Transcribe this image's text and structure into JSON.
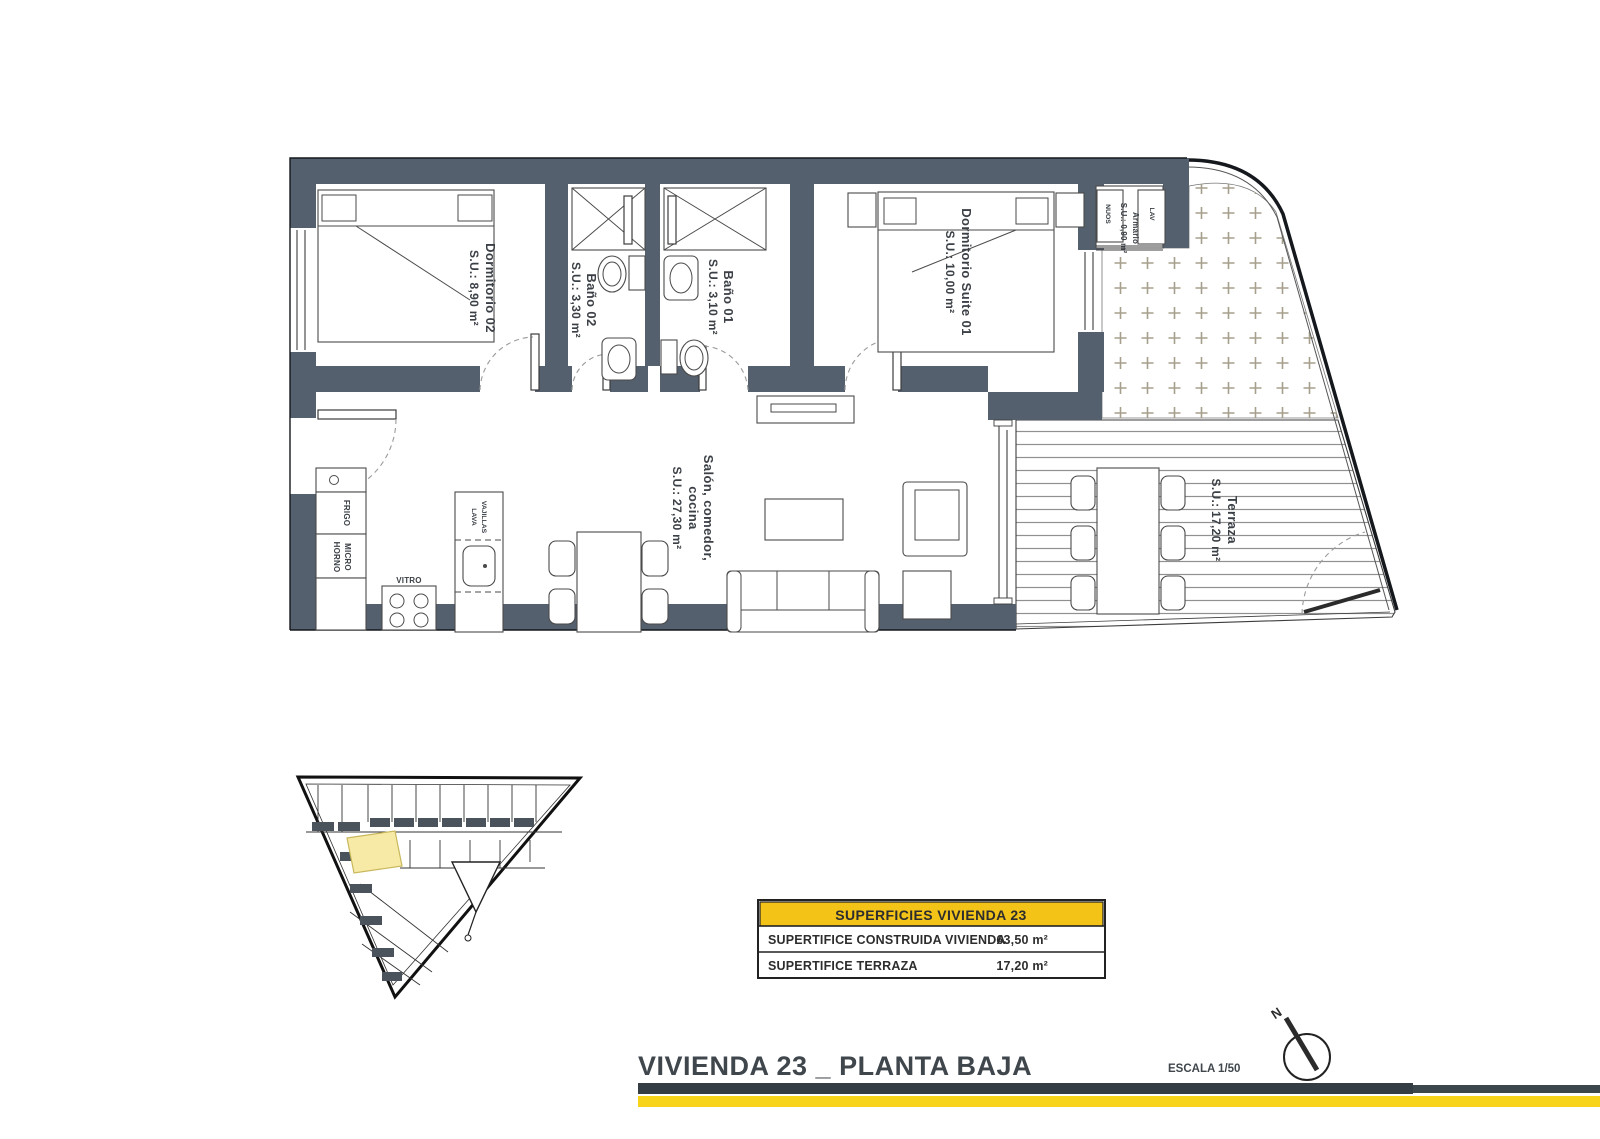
{
  "plan": {
    "rooms": {
      "dorm02": {
        "name": "Dormitorio 02",
        "area": "S.U.: 8,90 m²"
      },
      "bano02": {
        "name": "Baño 02",
        "area": "S.U.: 3,30 m²"
      },
      "bano01": {
        "name": "Baño 01",
        "area": "S.U.: 3,10 m²"
      },
      "suite": {
        "name": "Dormitorio Suite 01",
        "area": "S.U.: 10,00 m²"
      },
      "armario": {
        "name": "Armario",
        "area": "S.U.: 0,90 m²"
      },
      "salon": {
        "line1": "Salón, comedor,",
        "line2": "cocina",
        "area": "S.U.: 27,30 m²"
      },
      "terraza": {
        "name": "Terraza",
        "area": "S.U.: 17,20 m²"
      }
    },
    "kitchen": {
      "fridge": "FRIGO",
      "oven_line1": "HORNO",
      "oven_line2": "MICRO",
      "hob": "VITRO",
      "dishwasher_line1": "LAVA",
      "dishwasher_line2": "VAJILLAS"
    },
    "utility": {
      "washer": "LAV",
      "water_heater": "NUOS"
    }
  },
  "summary_table": {
    "header": "SUPERFICIES VIVIENDA 23",
    "rows": [
      {
        "label": "SUPERTIFICE CONSTRUIDA VIVIENDA",
        "value": "63,50 m²"
      },
      {
        "label": "SUPERTIFICE TERRAZA",
        "value": "17,20 m²"
      }
    ]
  },
  "footer": {
    "title": "VIVIENDA 23 _ PLANTA BAJA",
    "scale": "ESCALA 1/50",
    "north": "N"
  },
  "colors": {
    "wall": "#55606e",
    "table_header_yellow": "#f3c318",
    "footer_yellow": "#f7d41a",
    "footer_dark": "#333d43",
    "site_highlight": "#f7eaa6"
  }
}
